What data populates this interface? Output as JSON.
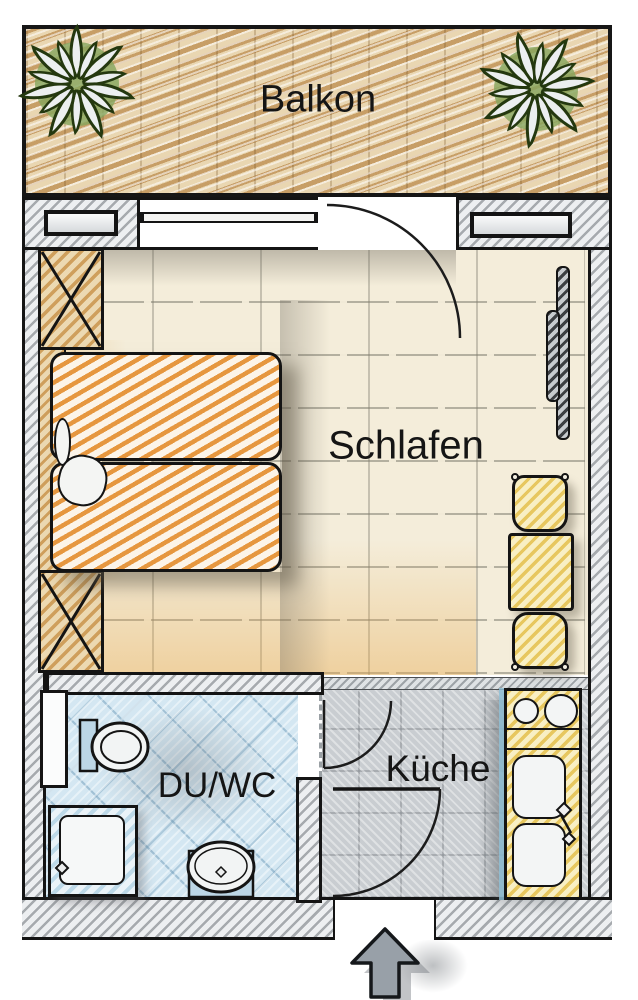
{
  "plan": {
    "title": "Apartment floor plan",
    "rooms": {
      "balcony": {
        "label": "Balkon",
        "fixtures": [
          "plant",
          "plant",
          "wood-deck"
        ]
      },
      "bedroom": {
        "label": "Schlafen",
        "fixtures": [
          "double-bed",
          "pillows",
          "nightstand",
          "nightstand",
          "radiator",
          "table",
          "chair",
          "chair",
          "window",
          "balcony-door"
        ]
      },
      "bathroom": {
        "label": "DU/WC",
        "fixtures": [
          "toilet",
          "shower",
          "washbasin",
          "door"
        ]
      },
      "kitchen": {
        "label": "Küche",
        "fixtures": [
          "stove-two-burners",
          "double-sink",
          "entry-door"
        ]
      }
    },
    "entrance": {
      "icon": "arrow-up-icon",
      "meaning": "apartment entrance"
    }
  },
  "colors": {
    "balcony_wood": "#c79e66",
    "bedroom_floor": "#f4edda",
    "bed_orange": "#e6973f",
    "furniture_yellow": "#e7c75f",
    "bathroom_blue": "#d4e7f2",
    "kitchen_gray": "#c9cdd1",
    "plant_green": "#85a55e",
    "outline": "#141414",
    "arrow_gray": "#98a0a8"
  }
}
